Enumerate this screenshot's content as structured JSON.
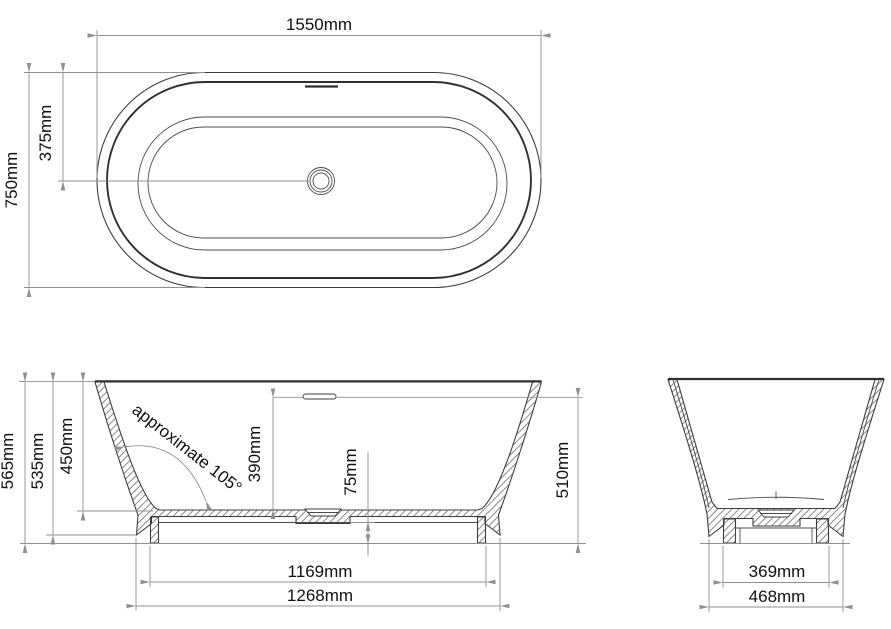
{
  "top_view": {
    "length": "1550mm",
    "width": "750mm",
    "drain_offset": "375mm"
  },
  "front_view": {
    "overall_height": "565mm",
    "skirt_height": "535mm",
    "depth_end": "450mm",
    "angle_note": "approximate 105°",
    "depth_center": "390mm",
    "drain_clearance": "75mm",
    "mid_rim_height": "510mm",
    "feet_span": "1169mm",
    "base_span": "1268mm"
  },
  "side_view": {
    "feet_width": "369mm",
    "base_width": "468mm"
  },
  "colors": {
    "line": "#3d3d3d",
    "dimension": "#8f8f8f",
    "text": "#111111",
    "hatch": "#6b6b6b",
    "background": "#ffffff"
  }
}
